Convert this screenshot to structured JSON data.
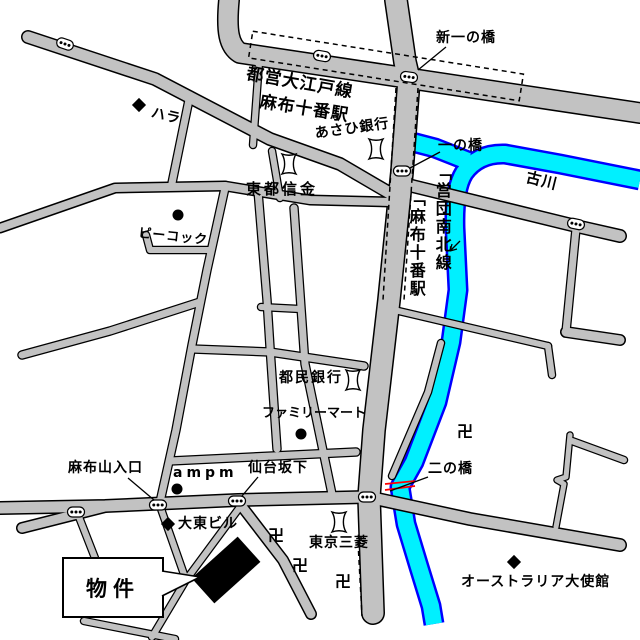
{
  "map": {
    "labels": {
      "oedo_line": "都営大江戸線",
      "oedo_station": "麻布十番駅",
      "asahi_bank": "あさひ銀行",
      "shin_ichinohashi": "新一の橋",
      "ichinohashi": "一の橋",
      "furukawa": "古川",
      "touto_shinkin": "東都信金",
      "hara": "ハラ",
      "peacock": "ピーコック",
      "namboku_line": "「営団南北線",
      "namboku_station": "「麻布十番駅",
      "tomin_bank": "都民銀行",
      "family_mart": "ファミリーマート",
      "sendai_sakashita": "仙台坂下",
      "ampm": "ampm",
      "azabuyama_entrance": "麻布山入口",
      "daito_building": "大東ビル",
      "property": "物件",
      "tokyo_mitsubishi": "東京三菱",
      "ninohashi": "二の橋",
      "australia_embassy": "オーストラリア大使館"
    },
    "symbols": {
      "temple": "卍"
    },
    "colors": {
      "road_fill": "#c2c2c2",
      "road_casing": "#000000",
      "river_fill": "#00f0ff",
      "river_edge": "#0000ff",
      "bridge_mark": "#ff0000",
      "property_building": "#000000",
      "background": "#ffffff"
    }
  }
}
